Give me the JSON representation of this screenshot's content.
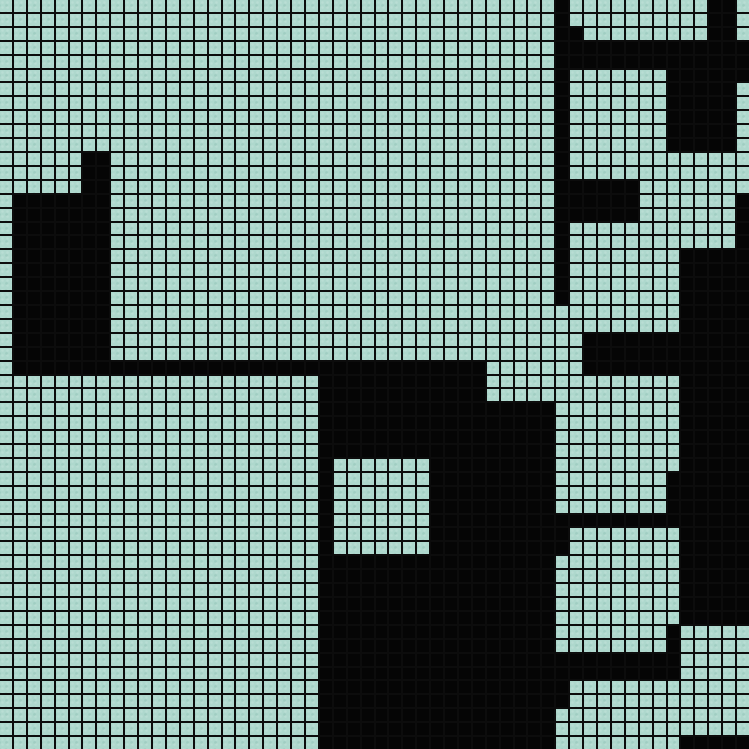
{
  "board": {
    "type": "tile-grid-map",
    "columns": 54,
    "rows_count": 54,
    "colors": {
      "open_tile": "#aed8cd",
      "wall_tile": "#050505",
      "grid_line": "#0c0c0c"
    },
    "legend": {
      "0": "open-tile",
      "1": "wall-tile"
    },
    "rows": [
      "000000000000000000000000000000000000000010000000000110",
      "000000000000000000000000000000000000000010000000000110",
      "000000000000000000000000000000000000000011000000000110",
      "000000000000000000000000000000000000000011111111111111",
      "000000000000000000000000000000000000000011111111111111",
      "000000000000000000000000000000000000000010000000111111",
      "000000000000000000000000000000000000000010000000111110",
      "000000000000000000000000000000000000000010000000111110",
      "000000000000000000000000000000000000000010000000111110",
      "000000000000000000000000000000000000000010000000111110",
      "000000000000000000000000000000000000000010000000111110",
      "000000110000000000000000000000000000000010000000000000",
      "000000110000000000000000000000000000000010000000000000",
      "000000110000000000000000000000000000000011111100000000",
      "011111110000000000000000000000000000000011111100000001",
      "011111110000000000000000000000000000000011111100000001",
      "011111110000000000000000000000000000000010000000000001",
      "011111110000000000000000000000000000000010000000000001",
      "011111110000000000000000000000000000000010000000011111",
      "011111110000000000000000000000000000000010000000011111",
      "011111110000000000000000000000000000000010000000011111",
      "011111110000000000000000000000000000000010000000011111",
      "011111110000000000000000000000000000000000000000011111",
      "011111110000000000000000000000000000000000000000011111",
      "011111110000000000000000000000000000000000111111111111",
      "011111110000000000000000000000000000000000111111111111",
      "011111111111111111111111111111111110000000111111111111",
      "000000000000000000000001111111111110000000000000011111",
      "000000000000000000000001111111111110000000000000011111",
      "000000000000000000000001111111111111111100000000011111",
      "000000000000000000000001111111111111111100000000011111",
      "000000000000000000000001111111111111111100000000011111",
      "000000000000000000000001111111111111111100000000011111",
      "000000000000000000000001000000011111111100000000011111",
      "000000000000000000000001000000011111111100000000111111",
      "000000000000000000000001000000011111111100000000111111",
      "000000000000000000000001000000011111111100000000111111",
      "000000000000000000000001000000011111111111111111111111",
      "000000000000000000000001000000011111111110000000011111",
      "000000000000000000000001000000011111111110000000011111",
      "000000000000000000000001111111111111111100000000011111",
      "000000000000000000000001111111111111111100000000011111",
      "000000000000000000000001111111111111111100000000011111",
      "000000000000000000000001111111111111111100000000011111",
      "000000000000000000000001111111111111111100000000011111",
      "000000000000000000000001111111111111111100000000100000",
      "000000000000000000000001111111111111111100000000100000",
      "000000000000000000000001111111111111111111111111100000",
      "000000000000000000000001111111111111111111111111100000",
      "000000000000000000000001111111111111111110000000000000",
      "000000000000000000000001111111111111111110000000000000",
      "000000000000000000000001111111111111111100000000000000",
      "000000000000000000000001111111111111111100000000000000",
      "000000000000000000000001111111111111111100000000011111"
    ]
  }
}
